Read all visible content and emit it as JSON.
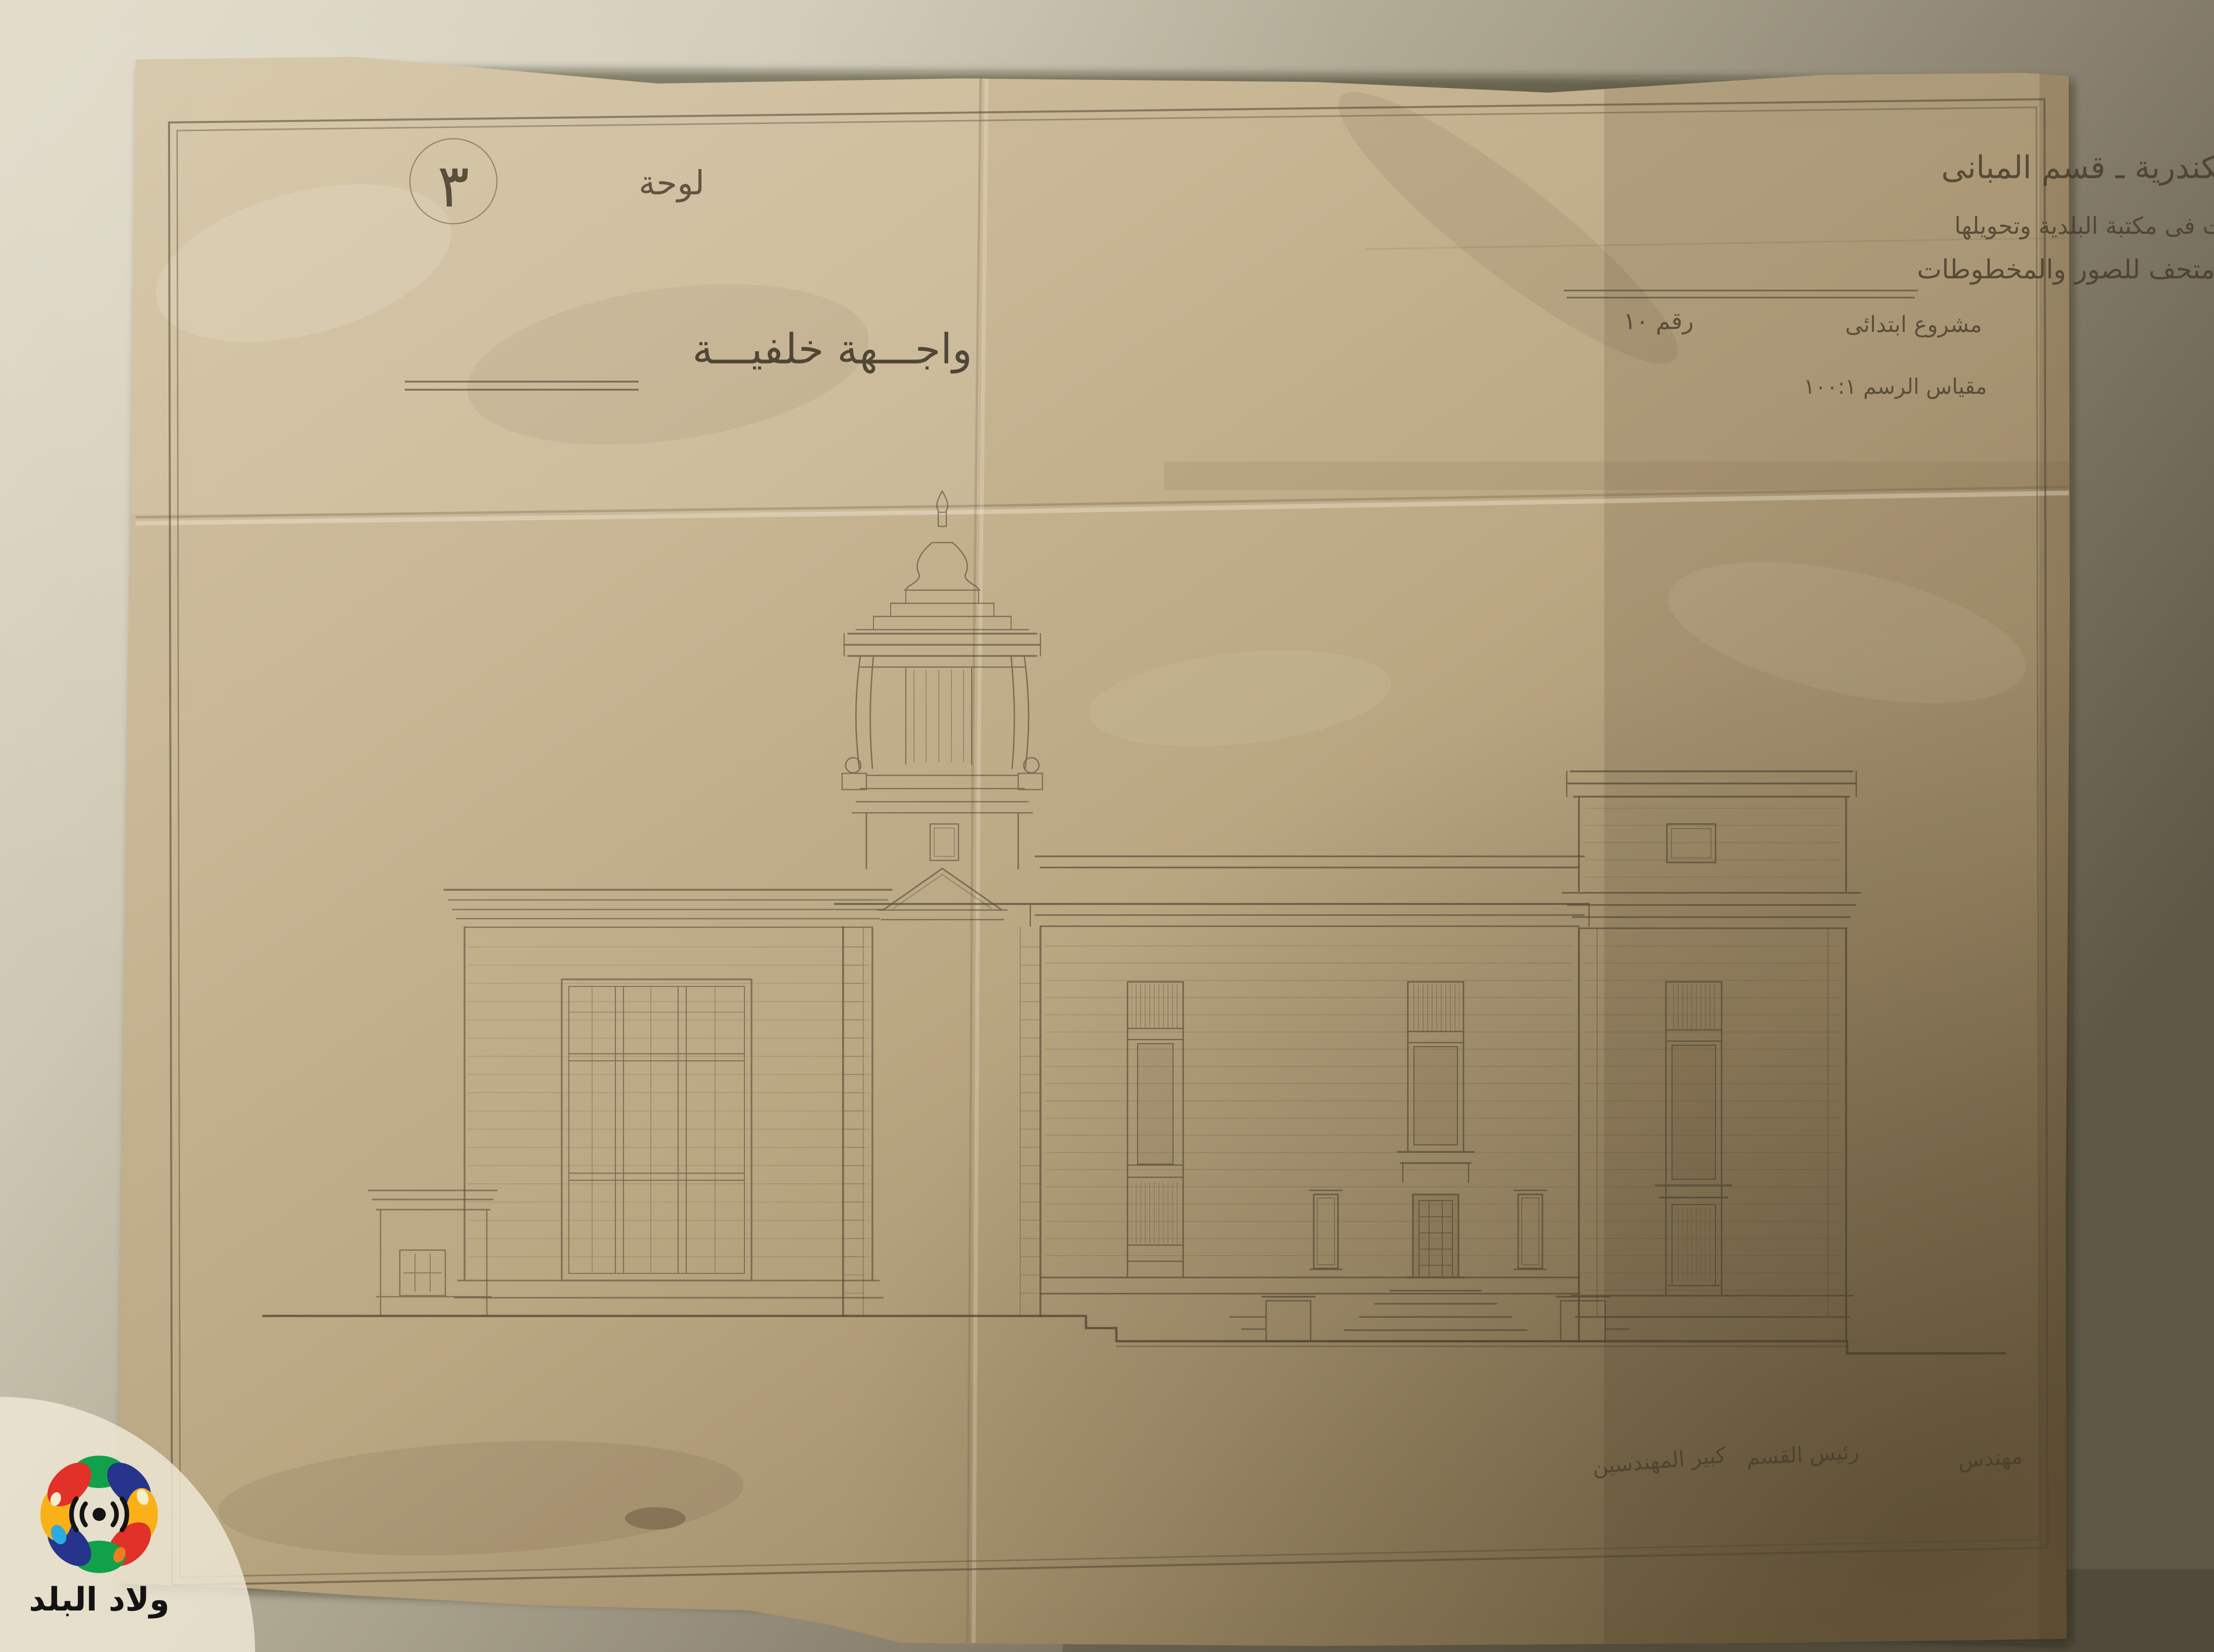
{
  "title_block": {
    "department_line": "بلدية الاسكندرية ـ قسم المبانى",
    "project_line1": "مشروع تعديلات فى مكتبة البلدية وتحويلها",
    "project_line2": "الى متحف للصور والمخطوطات",
    "stage_label": "مشروع ابتدائى",
    "number_label": "رقم ١٠",
    "scale_label": "مقياس الرسم ١٠٠:١"
  },
  "sheet_label": {
    "plate_word": "لوحة",
    "plate_number": "٣",
    "view_title": "واجـــهة خلفيـــة"
  },
  "signatures": {
    "engineer": "مهندس",
    "section_head": "رئيس القسم",
    "chief_engineer": "كبير المهندسين"
  },
  "watermark": {
    "name": "ولاد البلد",
    "colors": {
      "red": "#e23128",
      "blue": "#27348b",
      "yellow": "#f9b117",
      "green": "#12a14b",
      "cyan": "#2aabe2",
      "cream": "#f6edc9",
      "ink": "#131313"
    }
  },
  "palette": {
    "wall_light": "#dcd6c4",
    "wall_dark": "#5f5847",
    "paper_light": "#d4c4a4",
    "paper_dark": "#83714f",
    "graphite": "#463c2c"
  }
}
